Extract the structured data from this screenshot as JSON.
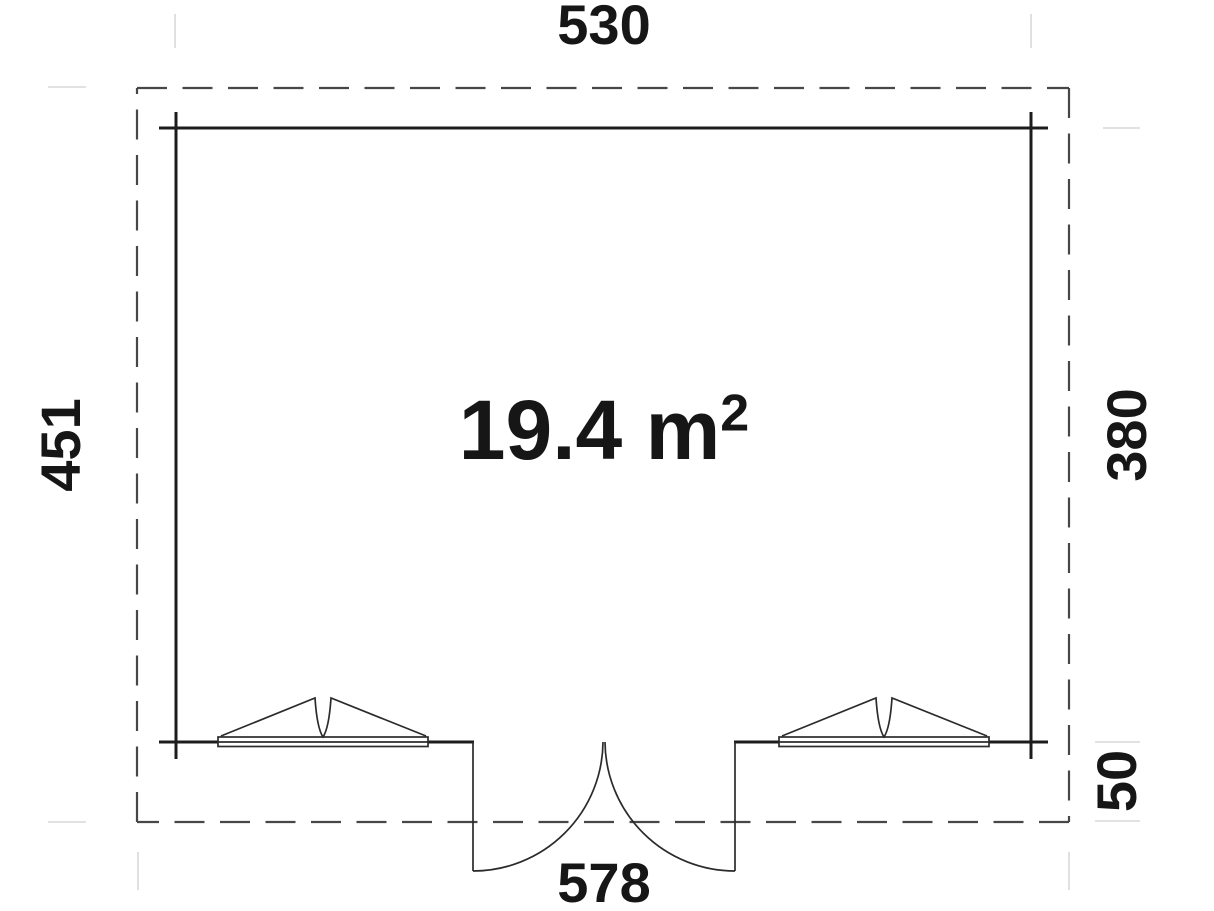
{
  "plan": {
    "type": "floor-plan",
    "area": {
      "value": "19.4 m",
      "superscript": "2"
    },
    "dimensions": {
      "width_top": "530",
      "depth_left": "451",
      "depth_right": "380",
      "overhang_right": "50",
      "width_bottom": "578"
    },
    "features": {
      "windows": 2,
      "doors": "double outward-swinging door, bottom center"
    },
    "colors": {
      "background": "#ffffff",
      "wall_line": "#1c1c1c",
      "overhang_dashed_line": "#474747",
      "fixture_line": "#2b2b2b",
      "extension_line": "#d9d9d9",
      "text": "#161616"
    }
  }
}
